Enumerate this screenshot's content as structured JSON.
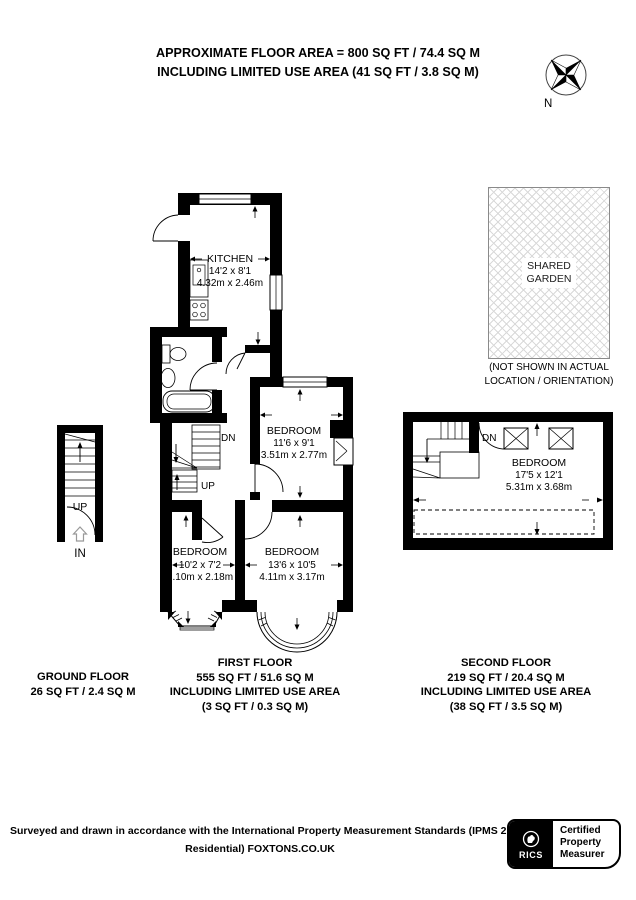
{
  "header": {
    "line1": "APPROXIMATE FLOOR AREA = 800 SQ FT / 74.4 SQ M",
    "line2": "INCLUDING LIMITED USE AREA (41 SQ FT / 3.8 SQ M)",
    "compass_n": "N"
  },
  "garden": {
    "line1": "SHARED",
    "line2": "GARDEN",
    "note1": "(NOT SHOWN IN ACTUAL",
    "note2": "LOCATION / ORIENTATION)"
  },
  "first_floor": {
    "kitchen": {
      "name": "KITCHEN",
      "imperial": "14'2 x 8'1",
      "metric": "4.32m x 2.46m"
    },
    "bedroom1": {
      "name": "BEDROOM",
      "imperial": "11'6 x 9'1",
      "metric": "3.51m x 2.77m"
    },
    "bedroom2": {
      "name": "BEDROOM",
      "imperial": "10'2 x 7'2",
      "metric": "3.10m x 2.18m"
    },
    "bedroom3": {
      "name": "BEDROOM",
      "imperial": "13'6 x 10'5",
      "metric": "4.11m x 3.17m"
    },
    "dn": "DN",
    "up": "UP"
  },
  "ground_floor": {
    "up": "UP",
    "in": "IN"
  },
  "second_floor": {
    "bedroom": {
      "name": "BEDROOM",
      "imperial": "17'5 x 12'1",
      "metric": "5.31m x 3.68m"
    },
    "dn": "DN"
  },
  "labels": {
    "ground": {
      "l1": "GROUND FLOOR",
      "l2": "26 SQ FT / 2.4 SQ M"
    },
    "first": {
      "l1": "FIRST FLOOR",
      "l2": "555 SQ FT / 51.6 SQ M",
      "l3": "INCLUDING LIMITED USE AREA",
      "l4": "(3 SQ FT / 0.3 SQ M)"
    },
    "second": {
      "l1": "SECOND FLOOR",
      "l2": "219 SQ FT / 20.4 SQ M",
      "l3": "INCLUDING LIMITED USE AREA",
      "l4": "(38 SQ FT / 3.5 SQ M)"
    }
  },
  "footer": {
    "line1": "Surveyed and drawn in accordance with the International Property Measurement Standards (IPMS 2:",
    "line2": "Residential) FOXTONS.CO.UK"
  },
  "rics": {
    "brand": "RICS",
    "cert1": "Certified",
    "cert2": "Property",
    "cert3": "Measurer"
  },
  "colors": {
    "wall": "#000000",
    "hatch_line": "#d9d9d9",
    "garden_border": "#8a8a8a",
    "gray_arrow": "#999999"
  }
}
